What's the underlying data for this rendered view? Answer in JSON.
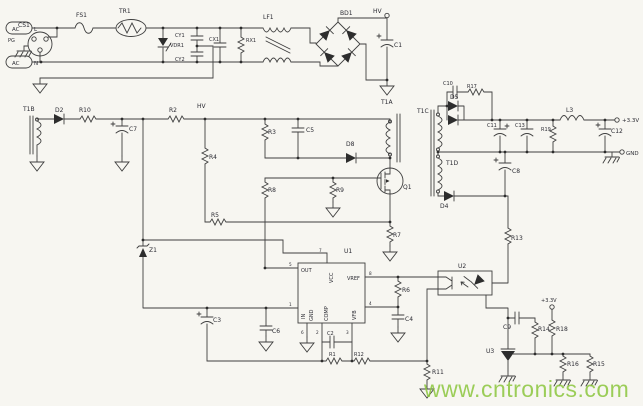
{
  "labels": {
    "ac": "AC",
    "l": "L",
    "n": "N",
    "pg": "PG",
    "cs1": "CS1",
    "fs1": "FS1",
    "tr1": "TR1",
    "vdr1": "VDR1",
    "cy1": "CY1",
    "cy2": "CY2",
    "cx1": "CX1",
    "rx1": "RX1",
    "lf1": "LF1",
    "bd1": "BD1",
    "c1": "C1",
    "hv": "HV",
    "t1b": "T1B",
    "d2": "D2",
    "r10": "R10",
    "c7": "C7",
    "r2": "R2",
    "r4": "R4",
    "r5": "R5",
    "z1": "Z1",
    "r3": "R3",
    "c5": "C5",
    "d8": "D8",
    "t1a": "T1A",
    "t1c": "T1C",
    "t1d": "T1D",
    "q1": "Q1",
    "r8": "R8",
    "r9": "R9",
    "r7": "R7",
    "u1": "U1",
    "u1_out": "OUT",
    "u1_vcc": "VCC",
    "u1_vref": "VREF",
    "u1_in": "IN",
    "u1_gnd": "GND",
    "u1_comp": "COMP",
    "u1_vfb": "VFB",
    "p1": "1",
    "p2": "2",
    "p3": "3",
    "p4": "4",
    "p5": "5",
    "p6": "6",
    "p7": "7",
    "p8": "8",
    "c2": "C2",
    "r1": "R1",
    "r12": "R12",
    "c3": "C3",
    "c6": "C6",
    "c4": "C4",
    "r6": "R6",
    "r11": "R11",
    "r13": "R13",
    "u2": "U2",
    "d5": "D5",
    "d4": "D4",
    "c10": "C10",
    "r17": "R17",
    "c8": "C8",
    "c11": "C11",
    "c13": "C13",
    "r19": "R19",
    "l3": "L3",
    "c12": "C12",
    "v33": "+3.3V",
    "gnd": "GND",
    "c9": "C9",
    "r14": "R14",
    "r18": "R18",
    "u3": "U3",
    "r16": "R16",
    "r15": "R15"
  },
  "watermark": {
    "text": "www.cntronics.com",
    "color": "#8cc63e"
  },
  "colors": {
    "background": "#f7f6f1",
    "wire": "#3f3f3f",
    "label": "#2b2b33",
    "watermark_green": "#8cc63e"
  }
}
